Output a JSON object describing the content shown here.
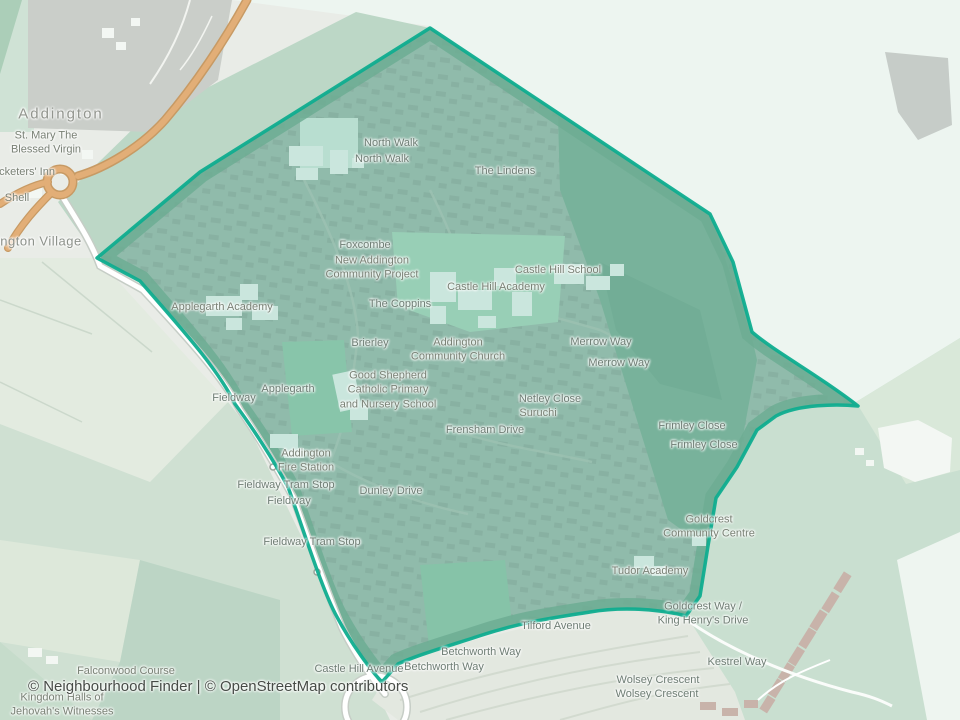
{
  "map": {
    "attribution": "© Neighbourhood Finder | © OpenStreetMap contributors"
  },
  "colors": {
    "boundary": "#0fad8f",
    "boundary_tint": "rgba(19,158,128,0.16)",
    "boundary_inner_band": "#7fb096",
    "primary_road": "#e2ae77",
    "residential_fill": "#a9c1b3",
    "woodland_fill": "#8cb7a0",
    "park_fill": "#b2d9c0",
    "background_mint": "#edf5f0"
  },
  "labels": [
    {
      "id": "addington",
      "kind": "place",
      "text": "Addington",
      "x": 61,
      "y": 114
    },
    {
      "id": "st-mary-the-blessed-virgin",
      "kind": "poi",
      "text": "St. Mary The\nBlessed Virgin",
      "x": 46,
      "y": 143
    },
    {
      "id": "cricketers-inn",
      "kind": "poi",
      "text": "Cricketers' Inn",
      "x": 20,
      "y": 172
    },
    {
      "id": "shell",
      "kind": "poi",
      "text": "Shell",
      "x": 17,
      "y": 198
    },
    {
      "id": "addington-village",
      "kind": "suburb",
      "text": "Addington Village",
      "x": 27,
      "y": 242
    },
    {
      "id": "north-walk-1",
      "kind": "street",
      "text": "North Walk",
      "x": 391,
      "y": 143
    },
    {
      "id": "north-walk-2",
      "kind": "street",
      "text": "North Walk",
      "x": 382,
      "y": 159
    },
    {
      "id": "the-lindens",
      "kind": "street",
      "text": "The Lindens",
      "x": 505,
      "y": 171
    },
    {
      "id": "foxcombe",
      "kind": "street",
      "text": "Foxcombe",
      "x": 365,
      "y": 245
    },
    {
      "id": "new-addington-community-project",
      "kind": "poi",
      "text": "New Addington\nCommunity Project",
      "x": 372,
      "y": 268
    },
    {
      "id": "castle-hill-school",
      "kind": "poi",
      "text": "Castle Hill School",
      "x": 558,
      "y": 270
    },
    {
      "id": "castle-hill-academy",
      "kind": "poi",
      "text": "Castle Hill Academy",
      "x": 496,
      "y": 287
    },
    {
      "id": "the-coppins",
      "kind": "street",
      "text": "The Coppins",
      "x": 400,
      "y": 304
    },
    {
      "id": "brierley",
      "kind": "street",
      "text": "Brierley",
      "x": 370,
      "y": 343
    },
    {
      "id": "addington-community-church",
      "kind": "poi",
      "text": "Addington\nCommunity Church",
      "x": 458,
      "y": 350
    },
    {
      "id": "merrow-way-1",
      "kind": "street",
      "text": "Merrow Way",
      "x": 601,
      "y": 342
    },
    {
      "id": "merrow-way-2",
      "kind": "street",
      "text": "Merrow Way",
      "x": 619,
      "y": 363
    },
    {
      "id": "good-shepherd-school",
      "kind": "poi",
      "text": "Good Shepherd\nCatholic Primary\nand Nursery School",
      "x": 388,
      "y": 390
    },
    {
      "id": "applegarth-academy",
      "kind": "poi",
      "text": "Applegarth Academy",
      "x": 222,
      "y": 307
    },
    {
      "id": "applegarth",
      "kind": "street",
      "text": "Applegarth",
      "x": 288,
      "y": 389
    },
    {
      "id": "fieldway-road-1",
      "kind": "street",
      "text": "Fieldway",
      "x": 234,
      "y": 398
    },
    {
      "id": "netley-close",
      "kind": "street",
      "text": "Netley Close",
      "x": 550,
      "y": 399
    },
    {
      "id": "suruchi",
      "kind": "poi",
      "text": "Suruchi",
      "x": 538,
      "y": 413
    },
    {
      "id": "frensham-drive",
      "kind": "street",
      "text": "Frensham Drive",
      "x": 485,
      "y": 430
    },
    {
      "id": "frimley-close-1",
      "kind": "street",
      "text": "Frimley Close",
      "x": 692,
      "y": 426
    },
    {
      "id": "frimley-close-2",
      "kind": "street",
      "text": "Frimley Close",
      "x": 704,
      "y": 445
    },
    {
      "id": "addington-fire-station",
      "kind": "poi",
      "text": "Addington\nFire Station",
      "x": 306,
      "y": 461
    },
    {
      "id": "fieldway-tram-stop-1",
      "kind": "station",
      "text": "Fieldway Tram Stop",
      "x": 286,
      "y": 485
    },
    {
      "id": "fieldway-road-2",
      "kind": "street",
      "text": "Fieldway",
      "x": 289,
      "y": 501
    },
    {
      "id": "dunley-drive",
      "kind": "street",
      "text": "Dunley Drive",
      "x": 391,
      "y": 491
    },
    {
      "id": "fieldway-tram-stop-2",
      "kind": "station",
      "text": "Fieldway Tram Stop",
      "x": 312,
      "y": 542
    },
    {
      "id": "goldcrest-community-centre",
      "kind": "poi",
      "text": "Goldcrest\nCommunity Centre",
      "x": 709,
      "y": 527
    },
    {
      "id": "tudor-academy",
      "kind": "poi",
      "text": "Tudor Academy",
      "x": 650,
      "y": 571
    },
    {
      "id": "goldcrest-way-king-henrys-drive",
      "kind": "station",
      "text": "Goldcrest Way /\nKing Henry's Drive",
      "x": 703,
      "y": 614
    },
    {
      "id": "tilford-avenue",
      "kind": "street",
      "text": "Tilford Avenue",
      "x": 556,
      "y": 626
    },
    {
      "id": "betchworth-way-1",
      "kind": "street",
      "text": "Betchworth Way",
      "x": 481,
      "y": 652
    },
    {
      "id": "betchworth-way-2",
      "kind": "street",
      "text": "Betchworth Way",
      "x": 444,
      "y": 667
    },
    {
      "id": "castle-hill-avenue",
      "kind": "street",
      "text": "Castle Hill Avenue",
      "x": 359,
      "y": 669
    },
    {
      "id": "wolsey-crescent-1",
      "kind": "street",
      "text": "Wolsey Crescent",
      "x": 658,
      "y": 680
    },
    {
      "id": "wolsey-crescent-2",
      "kind": "street",
      "text": "Wolsey Crescent",
      "x": 657,
      "y": 694
    },
    {
      "id": "kestrel-way",
      "kind": "street",
      "text": "Kestrel Way",
      "x": 737,
      "y": 662
    },
    {
      "id": "falconwood-course",
      "kind": "poi",
      "text": "Falconwood Course",
      "x": 126,
      "y": 671
    },
    {
      "id": "kingdom-halls",
      "kind": "poi",
      "text": "Kingdom Halls of\nJehovah's Witnesses",
      "x": 62,
      "y": 705
    }
  ]
}
